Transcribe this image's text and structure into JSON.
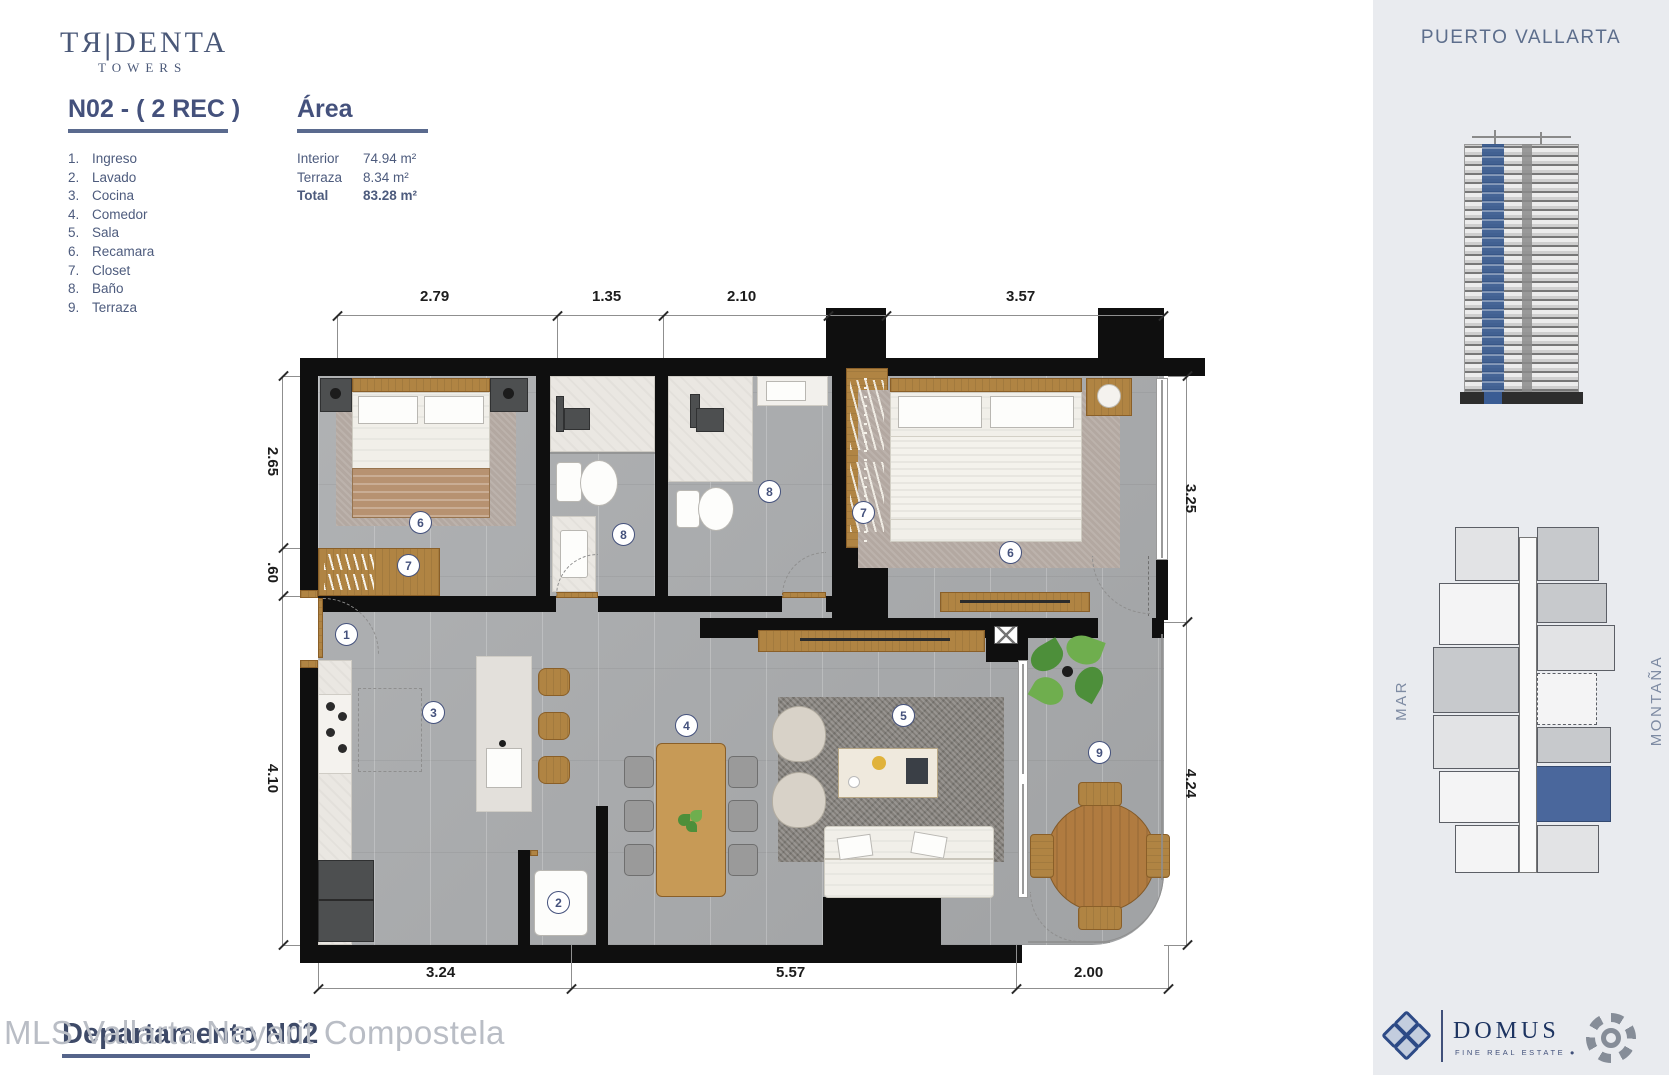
{
  "colors": {
    "navy": "#44517c",
    "wall_black": "#0f0f0f",
    "floor_gray": "#a9abad",
    "wood": "#b08443",
    "unit_highlight_blue": "#4a679c",
    "sidebar_bg": "#e9ebef",
    "watermark_gray": "#b9bdc5",
    "domus_navy": "#1d3461"
  },
  "header": {
    "brand_left": "TЯ",
    "brand_divider": "|",
    "brand_right": "DENTA",
    "brand_sub": "TOWERS"
  },
  "unit": {
    "title": "N02 - ( 2 REC )",
    "rooms": [
      {
        "n": "1.",
        "label": "Ingreso"
      },
      {
        "n": "2.",
        "label": "Lavado"
      },
      {
        "n": "3.",
        "label": "Cocina"
      },
      {
        "n": "4.",
        "label": "Comedor"
      },
      {
        "n": "5.",
        "label": "Sala"
      },
      {
        "n": "6.",
        "label": "Recamara"
      },
      {
        "n": "7.",
        "label": "Closet"
      },
      {
        "n": "8.",
        "label": "Baño"
      },
      {
        "n": "9.",
        "label": "Terraza"
      }
    ]
  },
  "area": {
    "title": "Área",
    "rows": [
      {
        "label": "Interior",
        "value": "74.94 m²"
      },
      {
        "label": "Terraza",
        "value": "8.34 m²"
      },
      {
        "label": "Total",
        "value": "83.28 m²"
      }
    ]
  },
  "plan": {
    "dims": {
      "top": [
        "2.79",
        "1.35",
        "2.10",
        "3.57"
      ],
      "left": [
        "2.65",
        ".60",
        "4.10"
      ],
      "right": [
        "3.25",
        "4.24"
      ],
      "bottom": [
        "3.24",
        "5.57",
        "2.00"
      ]
    },
    "markers": [
      {
        "n": "1",
        "room": "Ingreso"
      },
      {
        "n": "2",
        "room": "Lavado"
      },
      {
        "n": "3",
        "room": "Cocina"
      },
      {
        "n": "4",
        "room": "Comedor"
      },
      {
        "n": "5",
        "room": "Sala"
      },
      {
        "n": "6",
        "room": "Recamara"
      },
      {
        "n": "6",
        "room": "Recamara"
      },
      {
        "n": "7",
        "room": "Closet"
      },
      {
        "n": "7",
        "room": "Closet"
      },
      {
        "n": "8",
        "room": "Baño"
      },
      {
        "n": "8",
        "room": "Baño"
      },
      {
        "n": "9",
        "room": "Terraza"
      }
    ]
  },
  "sidebar": {
    "location": "PUERTO VALLARTA",
    "mar": "MAR",
    "montana": "MONTAÑA"
  },
  "footer": {
    "watermark": "MLS Vallarta Nayarit Compostela",
    "overlay_title": "Departamento N02",
    "domus_name": "DOMUS",
    "domus_tagline": "FINE REAL ESTATE  ●"
  }
}
